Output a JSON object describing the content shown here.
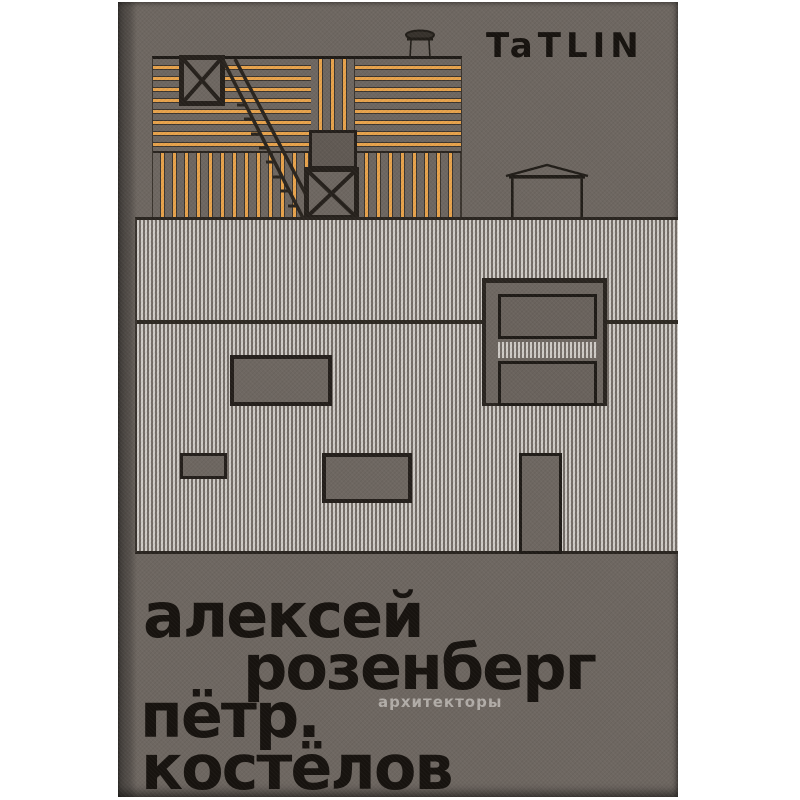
{
  "cover": {
    "publisher_logo": "TaTLIN",
    "title_lines": [
      "алексей",
      "розенберг",
      "пётр.",
      "костёлов"
    ],
    "subtitle": "архитекторы"
  },
  "colors": {
    "background": "#ffffff",
    "cover_taupe": "#6e6761",
    "accent_orange": "#e8a34c",
    "ink_black": "#17130f",
    "corrugation_light": "#d0ccc7",
    "window_fill": "#6a635d",
    "frame_dark": "#26211c",
    "subtitle_gray": "#b3aea9"
  }
}
